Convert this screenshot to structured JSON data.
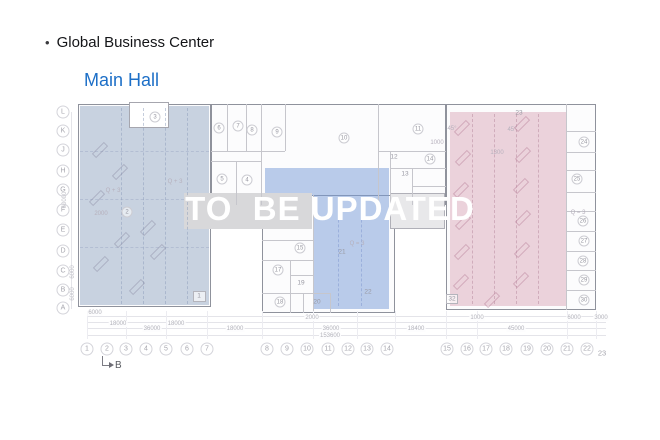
{
  "header": {
    "bullet": "•",
    "title": "Global Business Center",
    "subtitle": "Main Hall"
  },
  "watermark": "TO  BE UPDATED",
  "colors": {
    "subtitle_blue": "#1d6fc7",
    "overlay_left": "#93a7c4",
    "overlay_center": "#7599d7",
    "overlay_right": "#d9a7b9",
    "corridor_gray": "#d8d8da",
    "watermark_white": "#ffffff"
  },
  "plan": {
    "row_axis": [
      {
        "label": "L",
        "y": 112
      },
      {
        "label": "K",
        "y": 131
      },
      {
        "label": "J",
        "y": 150
      },
      {
        "label": "H",
        "y": 171
      },
      {
        "label": "G",
        "y": 190
      },
      {
        "label": "F",
        "y": 210
      },
      {
        "label": "E",
        "y": 230
      },
      {
        "label": "D",
        "y": 251
      },
      {
        "label": "C",
        "y": 271
      },
      {
        "label": "B",
        "y": 290
      },
      {
        "label": "A",
        "y": 308
      }
    ],
    "col_axis": [
      {
        "label": "1",
        "x": 87
      },
      {
        "label": "2",
        "x": 107
      },
      {
        "label": "3",
        "x": 126
      },
      {
        "label": "4",
        "x": 146
      },
      {
        "label": "5",
        "x": 166
      },
      {
        "label": "6",
        "x": 187
      },
      {
        "label": "7",
        "x": 207
      },
      {
        "label": "8",
        "x": 267
      },
      {
        "label": "9",
        "x": 287
      },
      {
        "label": "10",
        "x": 307
      },
      {
        "label": "11",
        "x": 328
      },
      {
        "label": "12",
        "x": 348
      },
      {
        "label": "13",
        "x": 367
      },
      {
        "label": "14",
        "x": 387
      },
      {
        "label": "15",
        "x": 447
      },
      {
        "label": "16",
        "x": 467
      },
      {
        "label": "17",
        "x": 486
      },
      {
        "label": "18",
        "x": 506
      },
      {
        "label": "19",
        "x": 527
      },
      {
        "label": "20",
        "x": 547
      },
      {
        "label": "21",
        "x": 567
      },
      {
        "label": "22",
        "x": 587
      }
    ],
    "col_axis_end": {
      "label": "23",
      "x": 602,
      "y": 353
    },
    "section_marker": {
      "label": "B"
    },
    "rooms_circled": [
      {
        "label": "3",
        "x": 155,
        "y": 117
      },
      {
        "label": "6",
        "x": 219,
        "y": 128
      },
      {
        "label": "7",
        "x": 238,
        "y": 126
      },
      {
        "label": "8",
        "x": 252,
        "y": 130
      },
      {
        "label": "9",
        "x": 277,
        "y": 132
      },
      {
        "label": "5",
        "x": 222,
        "y": 179
      },
      {
        "label": "4",
        "x": 247,
        "y": 180
      },
      {
        "label": "10",
        "x": 344,
        "y": 138
      },
      {
        "label": "11",
        "x": 418,
        "y": 129
      },
      {
        "label": "14",
        "x": 430,
        "y": 159
      },
      {
        "label": "2",
        "x": 127,
        "y": 212
      },
      {
        "label": "15",
        "x": 300,
        "y": 248
      },
      {
        "label": "17",
        "x": 278,
        "y": 270
      },
      {
        "label": "18",
        "x": 280,
        "y": 302
      },
      {
        "label": "24",
        "x": 584,
        "y": 142
      },
      {
        "label": "25",
        "x": 577,
        "y": 179
      },
      {
        "label": "26",
        "x": 583,
        "y": 221
      },
      {
        "label": "27",
        "x": 584,
        "y": 241
      },
      {
        "label": "28",
        "x": 583,
        "y": 261
      },
      {
        "label": "29",
        "x": 584,
        "y": 280
      },
      {
        "label": "30",
        "x": 584,
        "y": 300
      }
    ],
    "rooms_plain": [
      {
        "label": "12",
        "x": 394,
        "y": 157
      },
      {
        "label": "13",
        "x": 405,
        "y": 174
      },
      {
        "label": "19",
        "x": 301,
        "y": 283
      },
      {
        "label": "20",
        "x": 317,
        "y": 302
      },
      {
        "label": "21",
        "x": 342,
        "y": 252
      },
      {
        "label": "22",
        "x": 368,
        "y": 292
      },
      {
        "label": "23",
        "x": 519,
        "y": 113
      },
      {
        "label": "1",
        "x": 199,
        "y": 296
      },
      {
        "label": "32",
        "x": 452,
        "y": 299
      }
    ],
    "annotations": [
      {
        "text": "Q + 3",
        "x": 113,
        "y": 191
      },
      {
        "text": "Q + 3",
        "x": 175,
        "y": 182
      },
      {
        "text": "Q = 3",
        "x": 357,
        "y": 244
      },
      {
        "text": "Q = 3",
        "x": 578,
        "y": 213
      },
      {
        "text": "1000",
        "x": 437,
        "y": 143
      },
      {
        "text": "1300",
        "x": 497,
        "y": 153
      },
      {
        "text": "2000",
        "x": 101,
        "y": 214
      },
      {
        "text": "45°",
        "x": 452,
        "y": 129
      },
      {
        "text": "45°",
        "x": 512,
        "y": 130
      }
    ],
    "dim_rows": [
      {
        "y": 313,
        "items": [
          {
            "t": "6000",
            "x": 95
          }
        ]
      },
      {
        "y": 318,
        "items": [
          {
            "t": "2000",
            "x": 312
          },
          {
            "t": "1000",
            "x": 477
          },
          {
            "t": "6000",
            "x": 574
          },
          {
            "t": "3000",
            "x": 601
          }
        ]
      },
      {
        "y": 324,
        "items": [
          {
            "t": "18000",
            "x": 118
          },
          {
            "t": "18000",
            "x": 176
          }
        ]
      },
      {
        "y": 329,
        "items": [
          {
            "t": "36000",
            "x": 152
          },
          {
            "t": "18000",
            "x": 235
          },
          {
            "t": "36000",
            "x": 331
          },
          {
            "t": "18400",
            "x": 416
          },
          {
            "t": "45000",
            "x": 516
          }
        ]
      },
      {
        "y": 336,
        "items": [
          {
            "t": "153600",
            "x": 330
          }
        ]
      }
    ],
    "vertical_dims": [
      {
        "t": "60000",
        "x": 65,
        "y": 200
      },
      {
        "t": "6000",
        "x": 73,
        "y": 272
      },
      {
        "t": "6000",
        "x": 73,
        "y": 294
      }
    ]
  }
}
